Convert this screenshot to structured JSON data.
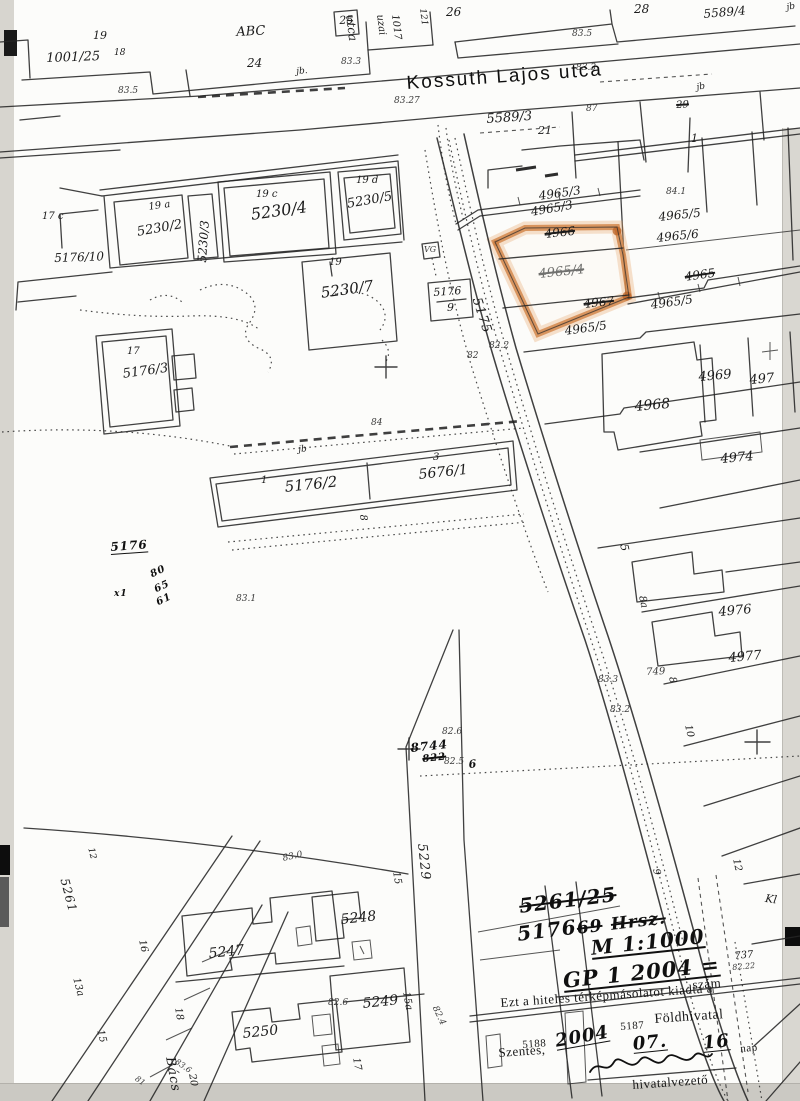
{
  "document": {
    "kind": "scanned cadastral map copy",
    "town": "Szentes,",
    "highlighted_parcel": "4965/4",
    "scale_note": "M 1:1000",
    "issuing_office": "Földhivatal"
  },
  "colors": {
    "highlight": "#d28445",
    "highlight_glow": "#e8a468",
    "highlight_blob": "#bc6426",
    "ink": "#1b1b1b",
    "paper": "#fcfcfa"
  },
  "street_names": [
    "Kossuth Lajos utca",
    "5175",
    "5229",
    "5261",
    "Bács",
    "utca"
  ],
  "stamp": {
    "number_line": "GP 1 2004 =",
    "number_word": "szám",
    "issue_line": "Ezt a hiteles térképmásolatot kiadta a",
    "office": "Földhivatal",
    "office_code_1": "5187",
    "office_code_2": "5188",
    "city": "Szentes,",
    "year": "2004",
    "month": "07.",
    "day": "16",
    "day_word": "nap",
    "signer_title": "hivatalvezető",
    "reference_note": "5261/25 5176/69 Hrsz. M 1:1000"
  },
  "labels": [
    {
      "id": "parcel-19-top",
      "t": "19",
      "x": 93,
      "y": 30,
      "s": 11,
      "r": 0,
      "c": "p"
    },
    {
      "id": "parcel-1001-25",
      "t": "1001/25",
      "x": 46,
      "y": 52,
      "s": 13,
      "r": -2,
      "c": "p"
    },
    {
      "id": "parcel-1001-25-sub",
      "t": "18",
      "x": 114,
      "y": 49,
      "s": 9,
      "r": 0,
      "c": "p"
    },
    {
      "id": "label-abc",
      "t": "ABC",
      "x": 236,
      "y": 26,
      "s": 13,
      "r": -3,
      "c": "p"
    },
    {
      "id": "parcel-24",
      "t": "24",
      "x": 247,
      "y": 57,
      "s": 12,
      "r": 0,
      "c": "p"
    },
    {
      "id": "parcel-25",
      "t": "25",
      "x": 339,
      "y": 15,
      "s": 11,
      "r": -3,
      "c": "p"
    },
    {
      "id": "street-utca-top",
      "t": "utca",
      "x": 356,
      "y": 14,
      "s": 12,
      "r": 83,
      "c": "p"
    },
    {
      "id": "label-1017",
      "t": "1017",
      "x": 399,
      "y": 14,
      "s": 10,
      "r": 83,
      "c": "p"
    },
    {
      "id": "label-uzai",
      "t": "uzai",
      "x": 384,
      "y": 14,
      "s": 10,
      "r": 83,
      "c": "p"
    },
    {
      "id": "label-121",
      "t": "121",
      "x": 426,
      "y": 8,
      "s": 9,
      "r": 83,
      "c": "p"
    },
    {
      "id": "parcel-26",
      "t": "26",
      "x": 446,
      "y": 6,
      "s": 12,
      "r": 0,
      "c": "p"
    },
    {
      "id": "parcel-28",
      "t": "28",
      "x": 634,
      "y": 3,
      "s": 12,
      "r": 0,
      "c": "p"
    },
    {
      "id": "parcel-5589-4",
      "t": "5589/4",
      "x": 703,
      "y": 8,
      "s": 12,
      "r": -5,
      "c": "p"
    },
    {
      "id": "label-jb-top-right",
      "t": "jb",
      "x": 786,
      "y": 4,
      "s": 9,
      "r": -10,
      "c": "p"
    },
    {
      "id": "label-jb-top",
      "t": "jb.",
      "x": 296,
      "y": 68,
      "s": 9,
      "r": -5,
      "c": "p"
    },
    {
      "id": "elev-83-5-left",
      "t": "83.5",
      "x": 118,
      "y": 87,
      "s": 9,
      "r": 0,
      "c": "e"
    },
    {
      "id": "elev-83-3-top",
      "t": "83.3",
      "x": 341,
      "y": 58,
      "s": 9,
      "r": 0,
      "c": "e"
    },
    {
      "id": "elev-83-5-mid",
      "t": "83.5",
      "x": 572,
      "y": 30,
      "s": 9,
      "r": 0,
      "c": "e"
    },
    {
      "id": "elev-83-27",
      "t": "83.27",
      "x": 394,
      "y": 97,
      "s": 9,
      "r": 0,
      "c": "e"
    },
    {
      "id": "elev-83-3-b",
      "t": "83.3",
      "x": 576,
      "y": 64,
      "s": 9,
      "r": 0,
      "c": "e"
    },
    {
      "id": "street-kossuth-lajos-utca",
      "t": "Kossuth Lajos utca",
      "x": 406,
      "y": 74,
      "s": 19,
      "r": -4,
      "c": "st-big"
    },
    {
      "id": "parcel-5589-3",
      "t": "5589/3",
      "x": 486,
      "y": 113,
      "s": 13,
      "r": -4,
      "c": "p"
    },
    {
      "id": "parcel-21",
      "t": "21",
      "x": 538,
      "y": 125,
      "s": 11,
      "r": 0,
      "c": "p"
    },
    {
      "id": "elev-87",
      "t": "87",
      "x": 586,
      "y": 105,
      "s": 9,
      "r": 0,
      "c": "e"
    },
    {
      "id": "parcel-29",
      "t": "29",
      "x": 676,
      "y": 101,
      "s": 10,
      "r": -3,
      "c": "p x"
    },
    {
      "id": "label-jb-right",
      "t": "jb",
      "x": 696,
      "y": 84,
      "s": 9,
      "r": -10,
      "c": "p"
    },
    {
      "id": "parcel-1-right",
      "t": "1",
      "x": 691,
      "y": 133,
      "s": 11,
      "r": 0,
      "c": "p"
    },
    {
      "id": "parcel-17c",
      "t": "17 c",
      "x": 42,
      "y": 212,
      "s": 10,
      "r": 0,
      "c": "p"
    },
    {
      "id": "parcel-19a",
      "t": "19 a",
      "x": 148,
      "y": 203,
      "s": 10,
      "r": -8,
      "c": "p"
    },
    {
      "id": "parcel-5230-2",
      "t": "5230/2",
      "x": 136,
      "y": 226,
      "s": 13,
      "r": -10,
      "c": "p"
    },
    {
      "id": "parcel-5230-3",
      "t": "5230/3",
      "x": 196,
      "y": 262,
      "s": 12,
      "r": -86,
      "c": "p"
    },
    {
      "id": "parcel-19c",
      "t": "19 c",
      "x": 256,
      "y": 190,
      "s": 10,
      "r": 0,
      "c": "p"
    },
    {
      "id": "parcel-5230-4",
      "t": "5230/4",
      "x": 250,
      "y": 207,
      "s": 16,
      "r": -8,
      "c": "p"
    },
    {
      "id": "parcel-19d",
      "t": "19 d",
      "x": 356,
      "y": 176,
      "s": 10,
      "r": 0,
      "c": "p"
    },
    {
      "id": "parcel-5230-5",
      "t": "5230/5",
      "x": 346,
      "y": 198,
      "s": 13,
      "r": -10,
      "c": "p"
    },
    {
      "id": "parcel-5176-10",
      "t": "5176/10",
      "x": 54,
      "y": 252,
      "s": 12,
      "r": -2,
      "c": "p"
    },
    {
      "id": "parcel-19-of-5230-7",
      "t": "19",
      "x": 329,
      "y": 258,
      "s": 10,
      "r": 0,
      "c": "p"
    },
    {
      "id": "parcel-5230-7",
      "t": "5230/7",
      "x": 320,
      "y": 286,
      "s": 15,
      "r": -8,
      "c": "p"
    },
    {
      "id": "parcel-17-of-5176-3",
      "t": "17",
      "x": 127,
      "y": 347,
      "s": 10,
      "r": 0,
      "c": "p"
    },
    {
      "id": "parcel-5176-3",
      "t": "5176/3",
      "x": 122,
      "y": 368,
      "s": 13,
      "r": -8,
      "c": "p"
    },
    {
      "id": "parcel-5176-9-numerator",
      "t": "5176",
      "x": 433,
      "y": 287,
      "s": 11,
      "r": -4,
      "c": "p"
    },
    {
      "id": "parcel-5176-9-denominator",
      "t": "9",
      "x": 447,
      "y": 302,
      "s": 11,
      "r": 0,
      "c": "p"
    },
    {
      "id": "label-vg",
      "t": "VG",
      "x": 424,
      "y": 246,
      "s": 8,
      "r": 0,
      "c": "e"
    },
    {
      "id": "street-5175",
      "t": "5175",
      "x": 482,
      "y": 296,
      "s": 13,
      "r": 72,
      "c": "s"
    },
    {
      "id": "parcel-4965-3-a",
      "t": "4965/3",
      "x": 538,
      "y": 190,
      "s": 12,
      "r": -8,
      "c": "p"
    },
    {
      "id": "parcel-4965-3-b",
      "t": "4965/3",
      "x": 530,
      "y": 206,
      "s": 12,
      "r": -10,
      "c": "p"
    },
    {
      "id": "parcel-4966",
      "t": "4966",
      "x": 544,
      "y": 228,
      "s": 12,
      "r": -6,
      "c": "p x"
    },
    {
      "id": "parcel-4965-4-highlighted",
      "t": "4965/4",
      "x": 538,
      "y": 268,
      "s": 13,
      "r": -6,
      "c": "p g x"
    },
    {
      "id": "parcel-4967",
      "t": "4967",
      "x": 583,
      "y": 298,
      "s": 12,
      "r": -6,
      "c": "p x"
    },
    {
      "id": "parcel-4965-struck",
      "t": "4965",
      "x": 684,
      "y": 271,
      "s": 12,
      "r": -8,
      "c": "p x"
    },
    {
      "id": "parcel-4965-5-right",
      "t": "4965/5",
      "x": 650,
      "y": 299,
      "s": 12,
      "r": -8,
      "c": "p"
    },
    {
      "id": "parcel-4965-5-bottom",
      "t": "4965/5",
      "x": 564,
      "y": 325,
      "s": 12,
      "r": -8,
      "c": "p"
    },
    {
      "id": "elev-84-1",
      "t": "84.1",
      "x": 666,
      "y": 188,
      "s": 9,
      "r": 0,
      "c": "e"
    },
    {
      "id": "parcel-4965-5-top",
      "t": "4965/5",
      "x": 658,
      "y": 211,
      "s": 12,
      "r": -6,
      "c": "p"
    },
    {
      "id": "parcel-4965-6",
      "t": "4965/6",
      "x": 656,
      "y": 232,
      "s": 12,
      "r": -6,
      "c": "p"
    },
    {
      "id": "elev-82-2",
      "t": "82.2",
      "x": 489,
      "y": 342,
      "s": 9,
      "r": 0,
      "c": "e"
    },
    {
      "id": "elev-82",
      "t": "82",
      "x": 467,
      "y": 352,
      "s": 9,
      "r": 0,
      "c": "e"
    },
    {
      "id": "parcel-4968",
      "t": "4968",
      "x": 634,
      "y": 400,
      "s": 14,
      "r": -5,
      "c": "p"
    },
    {
      "id": "parcel-4969",
      "t": "4969",
      "x": 698,
      "y": 371,
      "s": 13,
      "r": -5,
      "c": "p"
    },
    {
      "id": "parcel-497-cut",
      "t": "497",
      "x": 749,
      "y": 374,
      "s": 13,
      "r": -5,
      "c": "p"
    },
    {
      "id": "parcel-4974",
      "t": "4974",
      "x": 720,
      "y": 453,
      "s": 13,
      "r": -5,
      "c": "p"
    },
    {
      "id": "parcel-4976",
      "t": "4976",
      "x": 718,
      "y": 606,
      "s": 13,
      "r": -5,
      "c": "p"
    },
    {
      "id": "parcel-4977",
      "t": "4977",
      "x": 728,
      "y": 652,
      "s": 13,
      "r": -5,
      "c": "p"
    },
    {
      "id": "housenum-5",
      "t": "5",
      "x": 629,
      "y": 543,
      "s": 11,
      "r": 78,
      "c": "p"
    },
    {
      "id": "housenum-8a",
      "t": "8a",
      "x": 646,
      "y": 595,
      "s": 10,
      "r": 78,
      "c": "p"
    },
    {
      "id": "housenum-8",
      "t": "8",
      "x": 676,
      "y": 676,
      "s": 10,
      "r": 78,
      "c": "p"
    },
    {
      "id": "housenum-10",
      "t": "10",
      "x": 692,
      "y": 724,
      "s": 10,
      "r": 78,
      "c": "p"
    },
    {
      "id": "housenum-12",
      "t": "12",
      "x": 740,
      "y": 858,
      "s": 10,
      "r": 78,
      "c": "p"
    },
    {
      "id": "housenum-9",
      "t": "9",
      "x": 660,
      "y": 868,
      "s": 10,
      "r": 80,
      "c": "p"
    },
    {
      "id": "label-749",
      "t": "749",
      "x": 646,
      "y": 668,
      "s": 10,
      "r": -3,
      "c": "e"
    },
    {
      "id": "elev-83-3-c",
      "t": "83.3",
      "x": 598,
      "y": 676,
      "s": 9,
      "r": 0,
      "c": "e"
    },
    {
      "id": "elev-83-2",
      "t": "83.2",
      "x": 610,
      "y": 706,
      "s": 9,
      "r": 0,
      "c": "e"
    },
    {
      "id": "label-737",
      "t": "737",
      "x": 734,
      "y": 952,
      "s": 10,
      "r": -5,
      "c": "p"
    },
    {
      "id": "elev-82-22",
      "t": "82.22",
      "x": 732,
      "y": 964,
      "s": 8,
      "r": -5,
      "c": "e"
    },
    {
      "id": "label-kl-cut",
      "t": "Kl",
      "x": 766,
      "y": 893,
      "s": 11,
      "r": 8,
      "c": "p"
    },
    {
      "id": "elev-83-0",
      "t": "83.0",
      "x": 282,
      "y": 855,
      "s": 9,
      "r": -12,
      "c": "e"
    },
    {
      "id": "elev-84",
      "t": "84",
      "x": 371,
      "y": 419,
      "s": 9,
      "r": 0,
      "c": "e"
    },
    {
      "id": "label-jb-center",
      "t": "jb",
      "x": 298,
      "y": 446,
      "s": 9,
      "r": -5,
      "c": "p"
    },
    {
      "id": "housenum-1-strip",
      "t": "1",
      "x": 261,
      "y": 476,
      "s": 10,
      "r": 0,
      "c": "p"
    },
    {
      "id": "parcel-5176-2",
      "t": "5176/2",
      "x": 284,
      "y": 480,
      "s": 15,
      "r": -6,
      "c": "p"
    },
    {
      "id": "housenum-3-strip",
      "t": "3",
      "x": 433,
      "y": 453,
      "s": 10,
      "r": 0,
      "c": "p"
    },
    {
      "id": "parcel-5676-1",
      "t": "5676/1",
      "x": 418,
      "y": 468,
      "s": 14,
      "r": -6,
      "c": "p"
    },
    {
      "id": "housenum-8-strip",
      "t": "8",
      "x": 367,
      "y": 514,
      "s": 10,
      "r": 83,
      "c": "p"
    },
    {
      "id": "hand-5176",
      "t": "5176",
      "x": 110,
      "y": 541,
      "s": 12,
      "r": -4,
      "c": "h u"
    },
    {
      "id": "hand-80",
      "t": "80",
      "x": 149,
      "y": 571,
      "s": 10,
      "r": -25,
      "c": "h"
    },
    {
      "id": "hand-65",
      "t": "65",
      "x": 153,
      "y": 586,
      "s": 10,
      "r": -25,
      "c": "h"
    },
    {
      "id": "hand-61",
      "t": "61",
      "x": 155,
      "y": 599,
      "s": 10,
      "r": -25,
      "c": "h"
    },
    {
      "id": "hand-x1",
      "t": "x1",
      "x": 114,
      "y": 590,
      "s": 9,
      "r": 0,
      "c": "h"
    },
    {
      "id": "elev-83-1",
      "t": "83.1",
      "x": 236,
      "y": 595,
      "s": 9,
      "r": 0,
      "c": "e"
    },
    {
      "id": "elev-82-6",
      "t": "82.6",
      "x": 442,
      "y": 728,
      "s": 9,
      "r": 0,
      "c": "e"
    },
    {
      "id": "hand-8744",
      "t": "8744",
      "x": 410,
      "y": 742,
      "s": 12,
      "r": -6,
      "c": "h"
    },
    {
      "id": "hand-822",
      "t": "822",
      "x": 422,
      "y": 755,
      "s": 10,
      "r": -6,
      "c": "h x"
    },
    {
      "id": "elev-82-5",
      "t": "82.5",
      "x": 444,
      "y": 758,
      "s": 9,
      "r": 0,
      "c": "e"
    },
    {
      "id": "hand-6",
      "t": "6",
      "x": 468,
      "y": 759,
      "s": 11,
      "r": -6,
      "c": "h"
    },
    {
      "id": "street-5261",
      "t": "5261",
      "x": 70,
      "y": 877,
      "s": 12,
      "r": 75,
      "c": "s"
    },
    {
      "id": "housenum-12-bl",
      "t": "12",
      "x": 94,
      "y": 847,
      "s": 9,
      "r": 75,
      "c": "p"
    },
    {
      "id": "housenum-16",
      "t": "16",
      "x": 146,
      "y": 939,
      "s": 10,
      "r": 78,
      "c": "p"
    },
    {
      "id": "parcel-5247",
      "t": "5247",
      "x": 208,
      "y": 947,
      "s": 14,
      "r": -6,
      "c": "p"
    },
    {
      "id": "housenum-13a",
      "t": "13a",
      "x": 80,
      "y": 977,
      "s": 10,
      "r": 75,
      "c": "p"
    },
    {
      "id": "housenum-15-left",
      "t": "15",
      "x": 104,
      "y": 1029,
      "s": 10,
      "r": 75,
      "c": "p"
    },
    {
      "id": "housenum-18",
      "t": "18",
      "x": 182,
      "y": 1007,
      "s": 10,
      "r": 80,
      "c": "p"
    },
    {
      "id": "parcel-5250",
      "t": "5250",
      "x": 242,
      "y": 1027,
      "s": 14,
      "r": -6,
      "c": "p"
    },
    {
      "id": "street-bacs",
      "t": "Bács",
      "x": 176,
      "y": 1056,
      "s": 13,
      "r": 80,
      "c": "s"
    },
    {
      "id": "housenum-20",
      "t": "20",
      "x": 196,
      "y": 1073,
      "s": 10,
      "r": 80,
      "c": "p"
    },
    {
      "id": "elev-83-6",
      "t": "83.6",
      "x": 178,
      "y": 1058,
      "s": 8,
      "r": 35,
      "c": "e"
    },
    {
      "id": "elev-81",
      "t": "81",
      "x": 138,
      "y": 1075,
      "s": 8,
      "r": 35,
      "c": "e"
    },
    {
      "id": "housenum-15-center",
      "t": "15",
      "x": 400,
      "y": 871,
      "s": 10,
      "r": 80,
      "c": "p"
    },
    {
      "id": "parcel-5248",
      "t": "5248",
      "x": 340,
      "y": 913,
      "s": 14,
      "r": -6,
      "c": "p"
    },
    {
      "id": "elev-82-6-b",
      "t": "82.6",
      "x": 328,
      "y": 999,
      "s": 9,
      "r": 0,
      "c": "e"
    },
    {
      "id": "parcel-5249",
      "t": "5249",
      "x": 362,
      "y": 997,
      "s": 14,
      "r": -6,
      "c": "p"
    },
    {
      "id": "housenum-15a",
      "t": "15a",
      "x": 410,
      "y": 991,
      "s": 10,
      "r": 80,
      "c": "p"
    },
    {
      "id": "housenum-17",
      "t": "17",
      "x": 360,
      "y": 1057,
      "s": 10,
      "r": 80,
      "c": "p"
    },
    {
      "id": "street-5229",
      "t": "5229",
      "x": 428,
      "y": 843,
      "s": 13,
      "r": 84,
      "c": "s"
    },
    {
      "id": "elev-82-4",
      "t": "82.4",
      "x": 438,
      "y": 1005,
      "s": 9,
      "r": 65,
      "c": "e"
    },
    {
      "id": "hand-5261-25",
      "t": "5261/25",
      "x": 518,
      "y": 896,
      "s": 20,
      "r": -7,
      "c": "h x"
    },
    {
      "id": "hand-5176-ref",
      "t": "5176",
      "x": 516,
      "y": 924,
      "s": 20,
      "r": -7,
      "c": "h"
    },
    {
      "id": "hand-69",
      "t": "69",
      "x": 576,
      "y": 921,
      "s": 17,
      "r": -7,
      "c": "h x"
    },
    {
      "id": "hand-hrsz",
      "t": "Hrsz.",
      "x": 610,
      "y": 917,
      "s": 17,
      "r": -7,
      "c": "h x"
    },
    {
      "id": "hand-scale",
      "t": "M 1:1000",
      "x": 590,
      "y": 938,
      "s": 20,
      "r": -6,
      "c": "h u"
    },
    {
      "id": "hand-gp-number",
      "t": "GP 1 2004 =",
      "x": 562,
      "y": 970,
      "s": 21,
      "r": -6,
      "c": "h u"
    },
    {
      "id": "stamp-szam",
      "t": "szám",
      "x": 692,
      "y": 978,
      "s": 13,
      "r": -4,
      "c": "hp"
    },
    {
      "id": "stamp-issue-line",
      "t": "Ezt a hiteles térképmásolatot kiadta a",
      "x": 500,
      "y": 996,
      "s": 13,
      "r": -4,
      "c": "hp"
    },
    {
      "id": "stamp-5187",
      "t": "5187",
      "x": 620,
      "y": 1022,
      "s": 11,
      "r": -4,
      "c": "hp"
    },
    {
      "id": "stamp-foldhivatal",
      "t": "Földhivatal",
      "x": 654,
      "y": 1013,
      "s": 14,
      "r": -4,
      "c": "hp"
    },
    {
      "id": "stamp-5188",
      "t": "5188",
      "x": 522,
      "y": 1040,
      "s": 11,
      "r": -4,
      "c": "hp"
    },
    {
      "id": "stamp-szentes",
      "t": "Szentes,",
      "x": 498,
      "y": 1046,
      "s": 13,
      "r": -4,
      "c": "hp"
    },
    {
      "id": "hand-year-2004",
      "t": "2004",
      "x": 554,
      "y": 1033,
      "s": 18,
      "r": -10,
      "c": "h u"
    },
    {
      "id": "hand-month-07",
      "t": "07.",
      "x": 632,
      "y": 1036,
      "s": 18,
      "r": -6,
      "c": "h u"
    },
    {
      "id": "hand-day-16",
      "t": "16",
      "x": 702,
      "y": 1035,
      "s": 18,
      "r": -6,
      "c": "h u"
    },
    {
      "id": "stamp-nap",
      "t": "nap",
      "x": 740,
      "y": 1044,
      "s": 11,
      "r": -4,
      "c": "hp"
    },
    {
      "id": "stamp-hivatalvezeto",
      "t": "hivatalvezető",
      "x": 632,
      "y": 1078,
      "s": 13,
      "r": -4,
      "c": "hp"
    }
  ]
}
